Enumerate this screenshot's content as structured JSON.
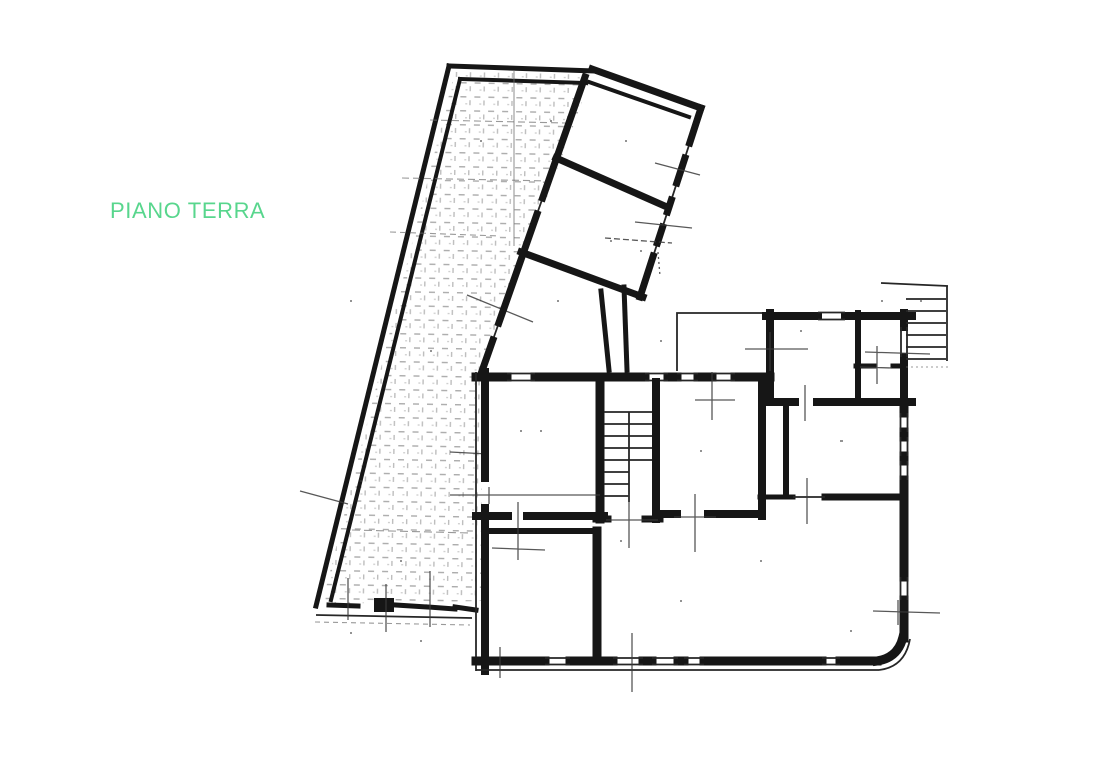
{
  "page": {
    "background_color": "#ffffff"
  },
  "title": {
    "text": "PIANO TERRA",
    "color": "#58d68d"
  },
  "drawing": {
    "ink_color": "#161616",
    "hatch_color": "#8f8f8f",
    "regions": [
      "courtyard-terrace",
      "wing-room-upper",
      "wing-room-lower",
      "wing-entry-hall",
      "duct-passage",
      "terrace-porch",
      "room-top-right",
      "bathroom",
      "bathroom-lobby",
      "external-staircase",
      "room-front-left",
      "internal-staircase",
      "room-center",
      "room-right",
      "room-bottom-left",
      "living-area"
    ]
  }
}
